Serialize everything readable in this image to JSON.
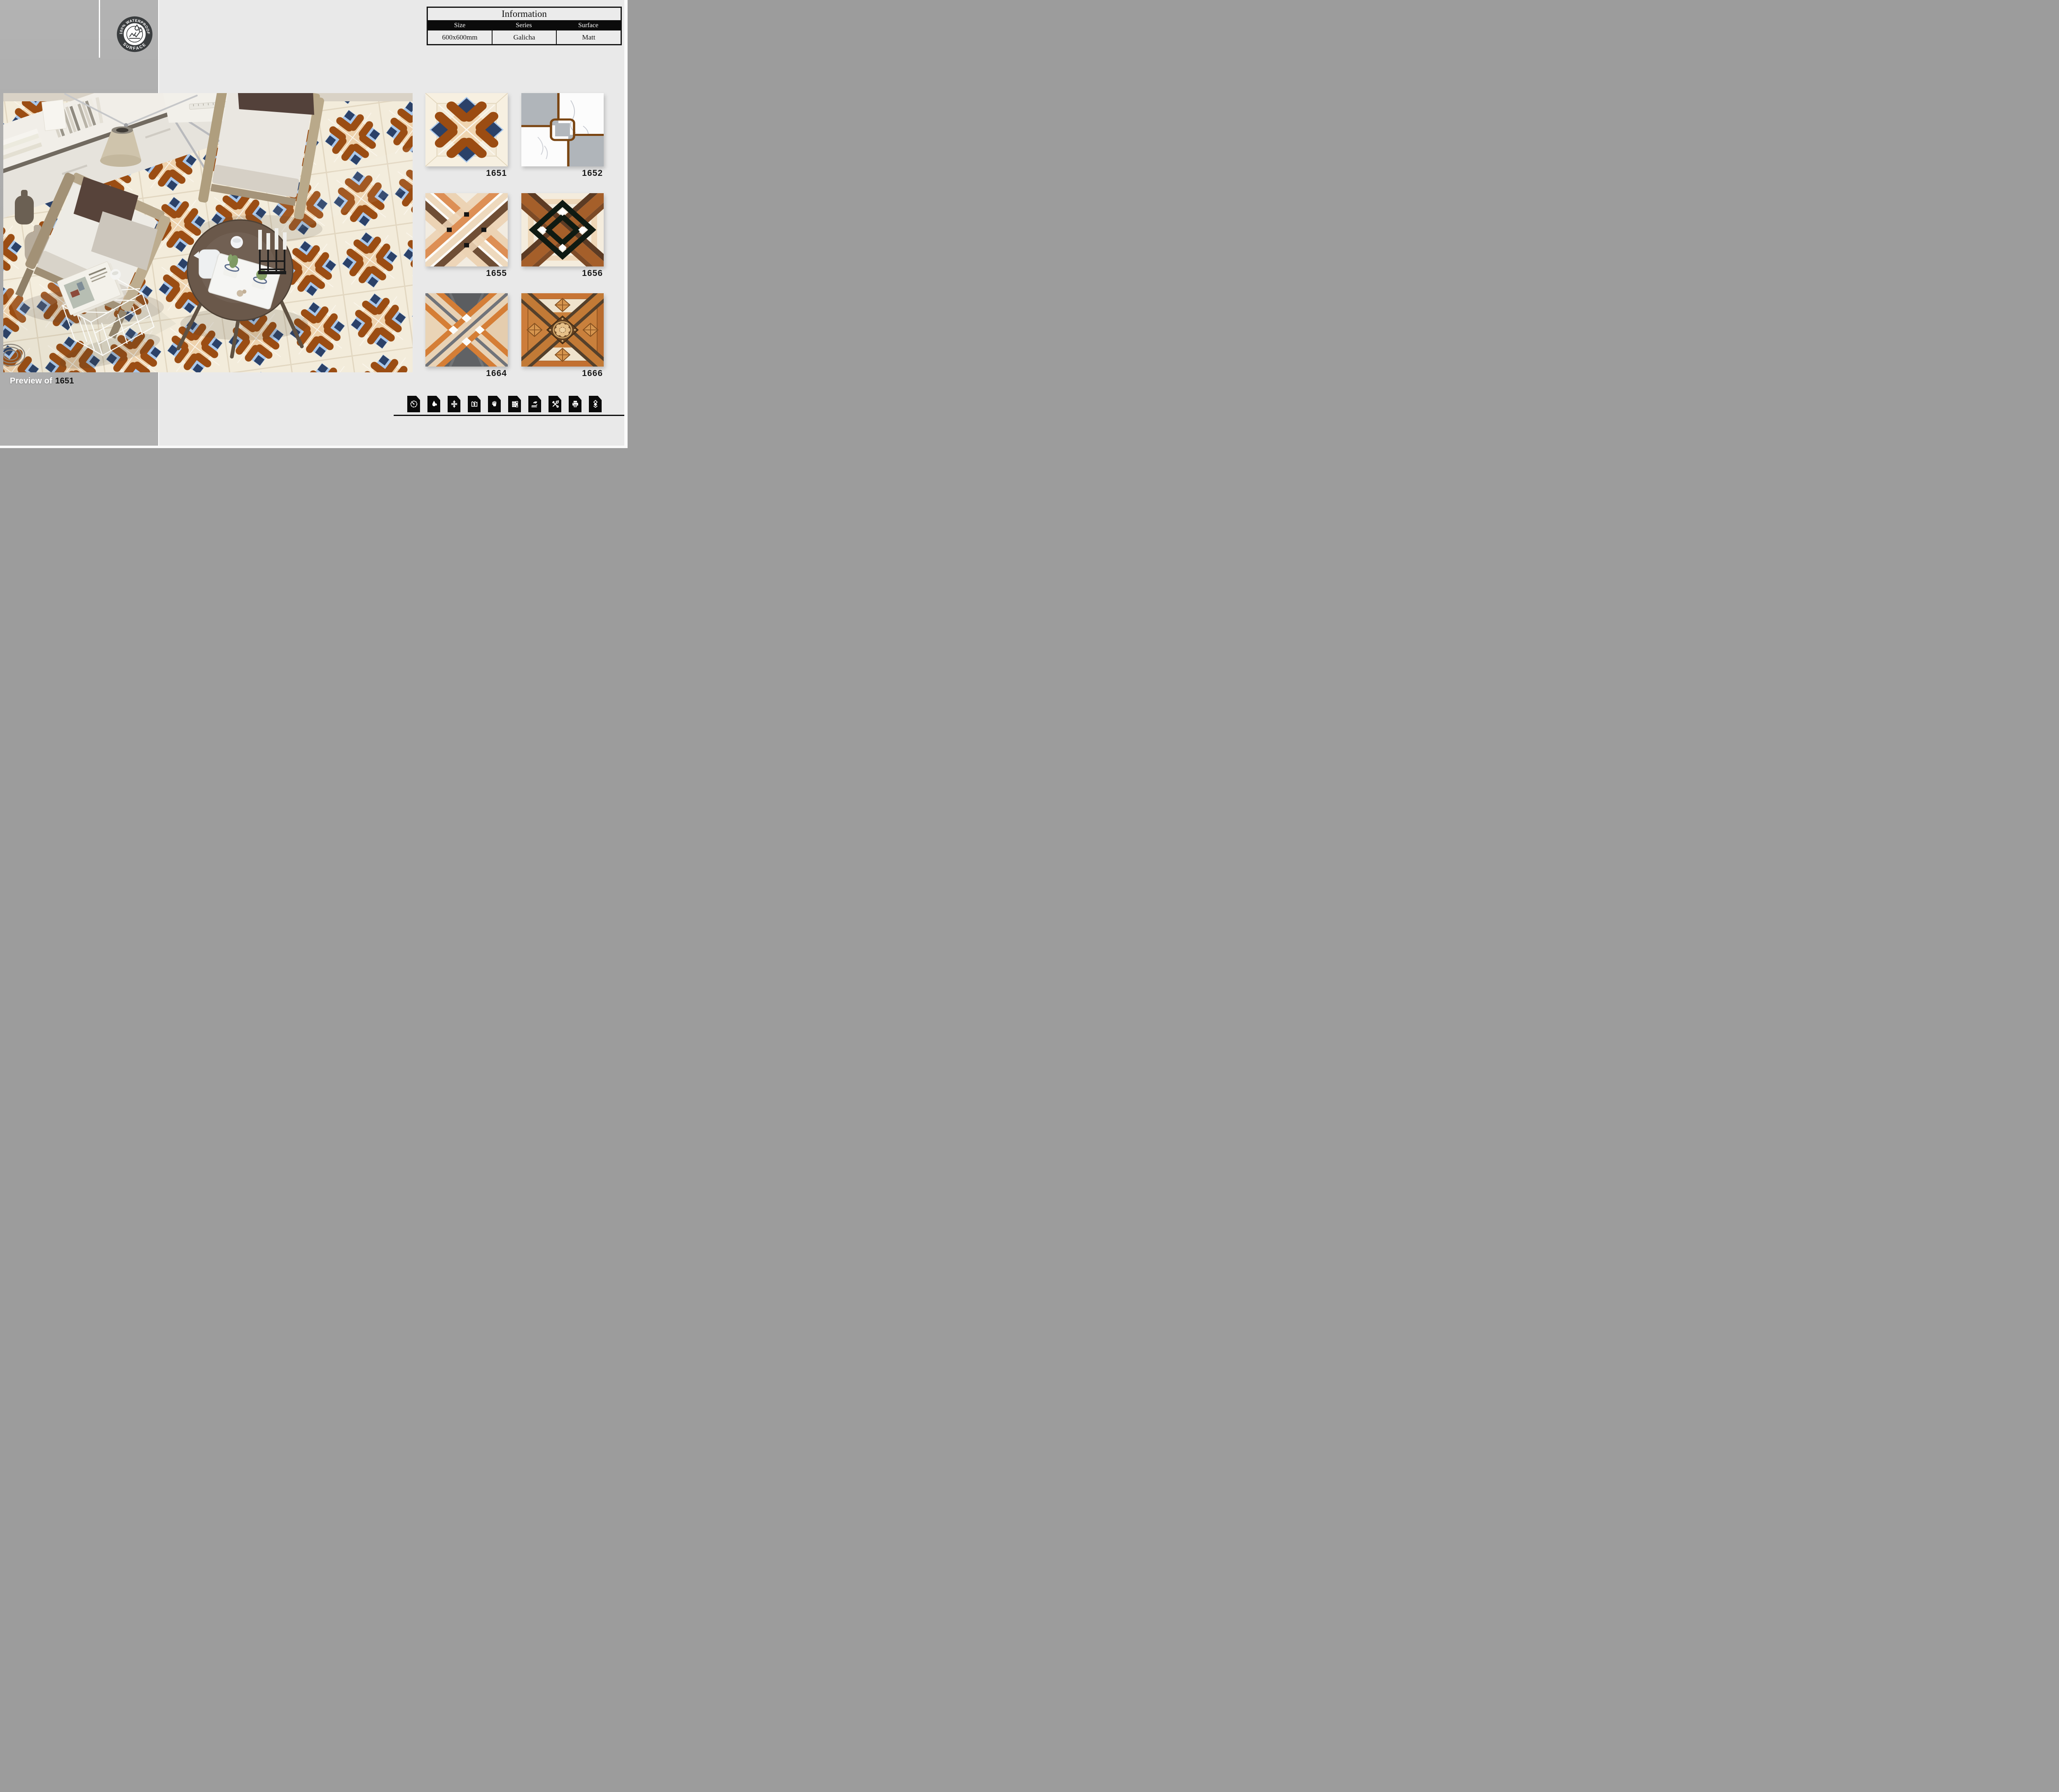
{
  "page": {
    "background": "#e9e9e9",
    "left_panel_color": "#acacac",
    "rule_color": "#0d0d0d"
  },
  "badge": {
    "arc_text_top": "100% WATERPROOF",
    "arc_text_bottom": "SURFACE"
  },
  "info_table": {
    "title": "Information",
    "columns": [
      "Size",
      "Series",
      "Surface"
    ],
    "row": {
      "size": "600x600mm",
      "series": "Galicha",
      "surface": "Matt"
    }
  },
  "preview": {
    "caption_prefix": "Preview of",
    "caption_tile": "1651"
  },
  "catalog": {
    "tiles": [
      {
        "id": "1651"
      },
      {
        "id": "1652"
      },
      {
        "id": "1655"
      },
      {
        "id": "1656"
      },
      {
        "id": "1664"
      },
      {
        "id": "1666"
      }
    ]
  },
  "feature_icons": [
    {
      "name": "wear-gauge-icon"
    },
    {
      "name": "water-drop-icon"
    },
    {
      "name": "compression-arrows-icon"
    },
    {
      "name": "thickness-measure-icon"
    },
    {
      "name": "hand-icon"
    },
    {
      "name": "tile-grid-icon"
    },
    {
      "name": "eco-hand-leaf-icon"
    },
    {
      "name": "tools-icon"
    },
    {
      "name": "printer-icon"
    },
    {
      "name": "stacked-tiles-icon"
    }
  ],
  "palette": {
    "tile_cream": "#f3ecdb",
    "tile_brown": "#9b4d13",
    "tile_navy": "#2b4168",
    "tile_light_blue": "#a9c8ec",
    "tile_peach": "#eed2ad",
    "swatch_orange": "#d57e36",
    "swatch_gray_wood": "#5d5f63",
    "swatch_dark_brown": "#54402b",
    "marble_gray": "#b0b5ba",
    "line_brown": "#7a4512"
  }
}
